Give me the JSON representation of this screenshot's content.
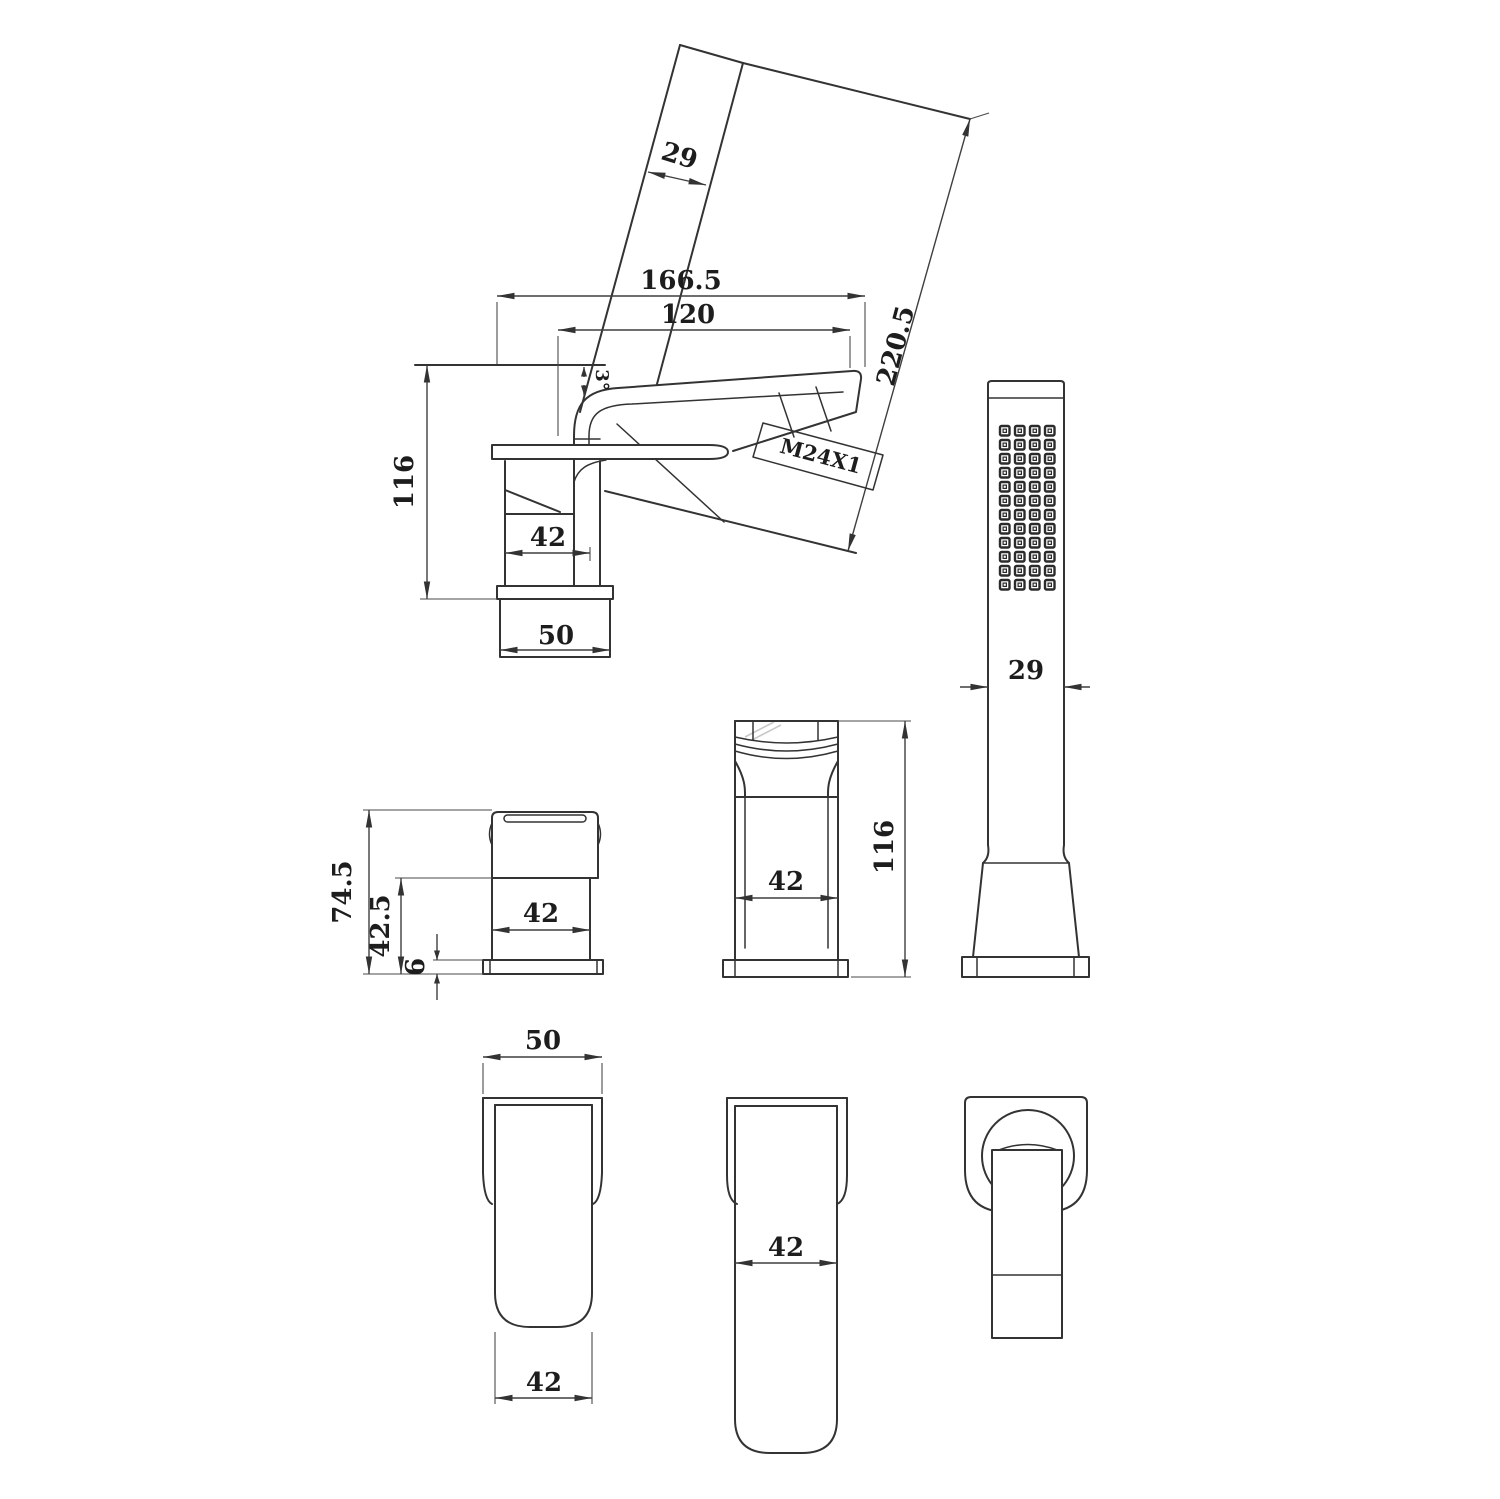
{
  "drawing": {
    "background": "#ffffff",
    "line_color": "#333333",
    "dim_text_color": "#1d1d1d",
    "views": {
      "faucet_side": {
        "name": "faucet side view",
        "dims": {
          "overall_reach": "166.5",
          "spout_reach": "120",
          "spout_angle": "3°",
          "height": "116",
          "body_width": "42",
          "base_width": "50",
          "aerator_thread": "M24X1"
        }
      },
      "handshower_profile": {
        "name": "hand shower tilted profile",
        "dims": {
          "head_width": "29",
          "overall_length": "220.5"
        }
      },
      "handshower_front": {
        "name": "hand shower front view",
        "dims": {
          "width": "29"
        },
        "spray_grid": {
          "cols": 4,
          "rows": 12
        }
      },
      "handle_side": {
        "name": "deck valve side view",
        "dims": {
          "overall_height": "74.5",
          "body_height": "42.5",
          "base_plate_thickness": "6",
          "body_width": "42"
        }
      },
      "faucet_front": {
        "name": "faucet front view",
        "dims": {
          "body_width": "42",
          "overall_height": "116"
        }
      },
      "body_top": {
        "name": "faucet body top view",
        "dims": {
          "base_width": "50",
          "handle_width": "42"
        }
      },
      "spout_top": {
        "name": "spout top view",
        "dims": {
          "width": "42"
        }
      },
      "handle_top": {
        "name": "handle top view",
        "dims": {}
      }
    }
  }
}
